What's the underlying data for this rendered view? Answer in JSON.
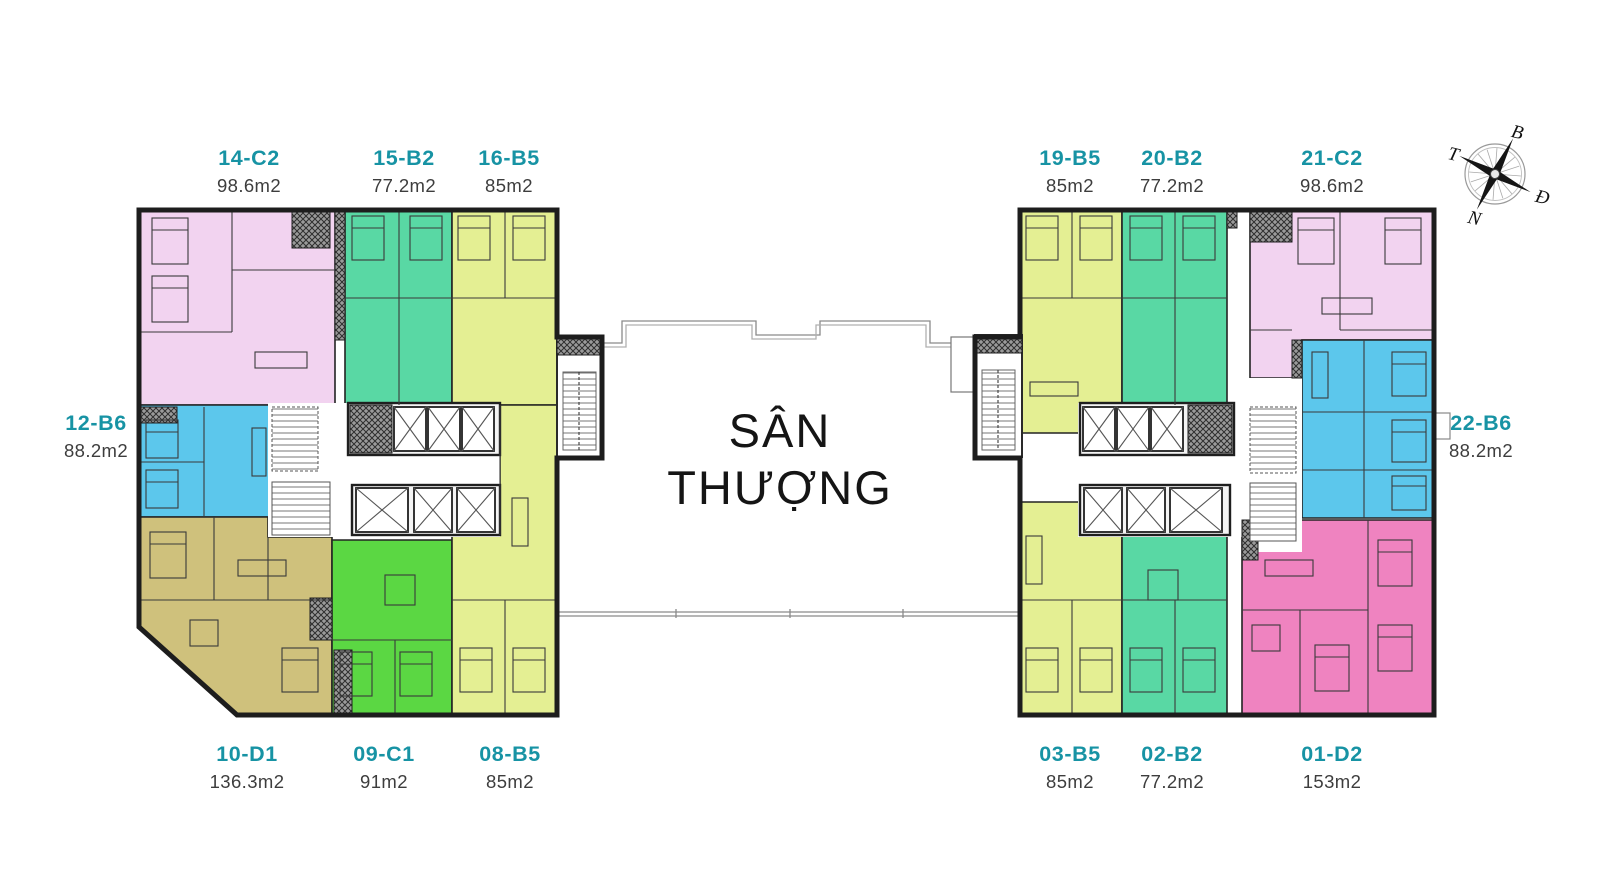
{
  "terrace_label": {
    "line1": "SÂN",
    "line2": "THƯỢNG"
  },
  "compass": {
    "north": "B",
    "west": "T",
    "east": "Đ",
    "south": "N"
  },
  "colors": {
    "C2": "#f2d3f0",
    "B2": "#59d8a4",
    "B5": "#e4ef93",
    "B6": "#5cc7ec",
    "D1": "#cfc17c",
    "C1": "#5bd743",
    "D2": "#ef83c0",
    "label_text": "#1793a4",
    "area_text": "#3d3d3d",
    "wall": "#1d1d1d"
  },
  "units": [
    {
      "code": "14-C2",
      "area": "98.6m2",
      "type": "C2"
    },
    {
      "code": "15-B2",
      "area": "77.2m2",
      "type": "B2"
    },
    {
      "code": "16-B5",
      "area": "85m2",
      "type": "B5"
    },
    {
      "code": "12-B6",
      "area": "88.2m2",
      "type": "B6"
    },
    {
      "code": "10-D1",
      "area": "136.3m2",
      "type": "D1"
    },
    {
      "code": "09-C1",
      "area": "91m2",
      "type": "C1"
    },
    {
      "code": "08-B5",
      "area": "85m2",
      "type": "B5"
    },
    {
      "code": "19-B5",
      "area": "85m2",
      "type": "B5"
    },
    {
      "code": "20-B2",
      "area": "77.2m2",
      "type": "B2"
    },
    {
      "code": "21-C2",
      "area": "98.6m2",
      "type": "C2"
    },
    {
      "code": "22-B6",
      "area": "88.2m2",
      "type": "B6"
    },
    {
      "code": "03-B5",
      "area": "85m2",
      "type": "B5"
    },
    {
      "code": "02-B2",
      "area": "77.2m2",
      "type": "B2"
    },
    {
      "code": "01-D2",
      "area": "153m2",
      "type": "D2"
    }
  ]
}
